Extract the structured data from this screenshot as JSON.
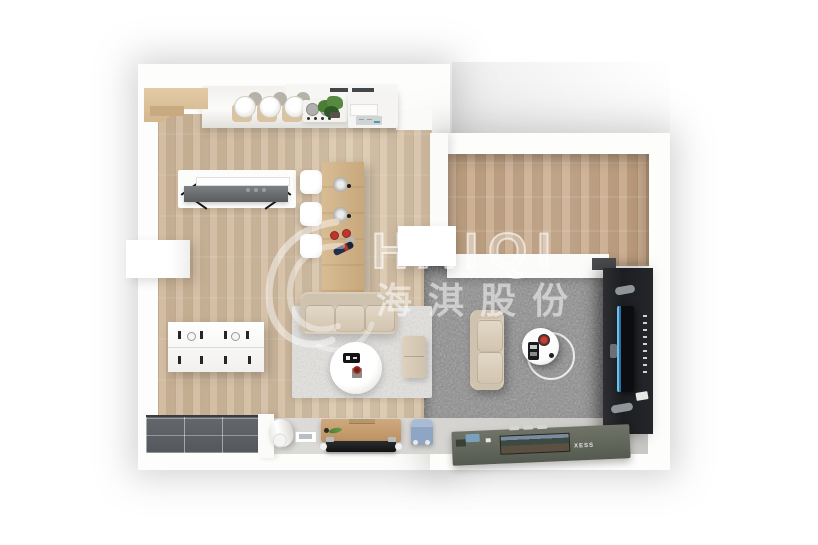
{
  "watermark": {
    "brand": "HAIQI",
    "company": "海淇股份"
  },
  "labels": {
    "flat_tv_brand": "XESS"
  },
  "palette": {
    "background": "#ffffff",
    "wall": "#fbfbfa",
    "wood_floor_main": "#d2bca1",
    "wood_floor_bedroom": "#c6a888",
    "carpet_gray": "#8b8b8b",
    "rug_light": "#e4e3e0",
    "balcony_tile": "#5b5f63",
    "sofa_beige": "#d9cdbb",
    "table_wood": "#cfb38b",
    "tv_wall_black": "#1e2023",
    "tv_screen_blue": "#6cc0ee",
    "chair_blue": "#8ea6c4",
    "accent_red": "#c0342e",
    "plant_green": "#4c7d35"
  },
  "rooms": {
    "kitchen": {
      "items": [
        "upper-cabinets",
        "wood-shelf",
        "bar-stools",
        "cookware",
        "stove",
        "herb-plant",
        "appliance-cabinet",
        "control-panel"
      ]
    },
    "dining": {
      "items": [
        "console-desk",
        "wall-shelf",
        "dining-table",
        "white-chairs",
        "steel-pots",
        "red-cups",
        "wine-bottle"
      ]
    },
    "entry": {
      "items": [
        "shoe-dresser",
        "left-door"
      ]
    },
    "living": {
      "items": [
        "three-seat-sofa",
        "area-rug",
        "round-coffee-table",
        "serving-tray",
        "flower-pot",
        "ottoman"
      ]
    },
    "den": {
      "items": [
        "gray-carpet",
        "loveseat",
        "round-side-table",
        "smart-speaker",
        "tv-feature-wall",
        "wall-tv"
      ]
    },
    "bedroom": {
      "items": []
    },
    "balcony": {
      "items": [
        "dark-tile-floor"
      ]
    },
    "hallway": {
      "items": [
        "water-heater",
        "tablet",
        "media-cabinet",
        "tv-panel",
        "kids-chair",
        "flat-tv"
      ]
    }
  }
}
